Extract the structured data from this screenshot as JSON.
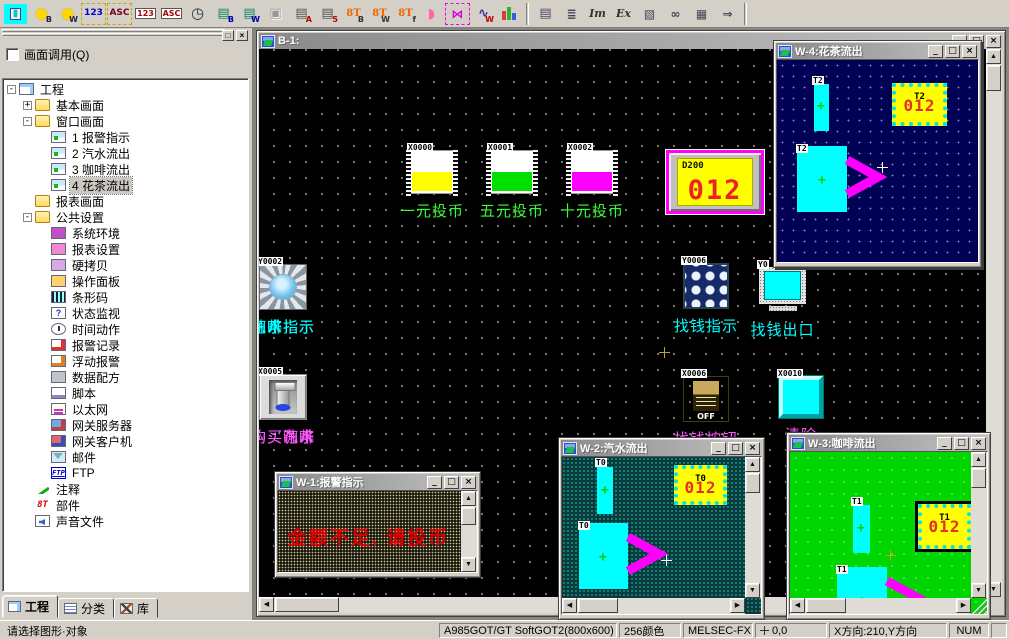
{
  "toolbar": {
    "group1": [
      {
        "name": "parts-select-dropdown-icon",
        "main": "S",
        "sub": "▾",
        "cls": "s-red"
      },
      {
        "name": "lamp-b-icon",
        "main": "●",
        "sub": "B",
        "cls": "lamp"
      },
      {
        "name": "lamp-w-icon",
        "main": "●",
        "sub": "W",
        "cls": "lamp"
      },
      {
        "name": "numeric-input-icon",
        "main": "123",
        "cls": "dashed blue"
      },
      {
        "name": "ascii-input-icon",
        "main": "ASC",
        "cls": "dashed dark"
      },
      {
        "name": "numeric-display-icon",
        "main": "123",
        "cls": "boxed"
      },
      {
        "name": "ascii-display-icon",
        "main": "ASC",
        "cls": "boxed"
      },
      {
        "name": "clock-display-icon",
        "main": "◷",
        "cls": "clock"
      },
      {
        "name": "comment-display-b-icon",
        "main": "▤",
        "sub": "B",
        "cls": "green-doc"
      },
      {
        "name": "comment-display-w-icon",
        "main": "▤",
        "sub": "W",
        "cls": "green-doc"
      },
      {
        "name": "paste-disabled-icon",
        "main": "▣",
        "cls": "disabled"
      },
      {
        "name": "alarm-history-icon",
        "main": "▤",
        "sub": "A",
        "cls": "alarm"
      },
      {
        "name": "alarm-list-icon",
        "main": "▤",
        "sub": "5",
        "cls": "alarm"
      },
      {
        "name": "parts-display-b-icon",
        "main": "8T",
        "sub": "B",
        "cls": "orange"
      },
      {
        "name": "parts-display-w-icon",
        "main": "8T",
        "sub": "W",
        "cls": "orange"
      },
      {
        "name": "parts-display-f-icon",
        "main": "8T",
        "sub": "f",
        "cls": "orange"
      },
      {
        "name": "panel-meter-icon",
        "main": "◗",
        "cls": "pink"
      },
      {
        "name": "tank-icon",
        "main": "▮",
        "cls": "tank"
      },
      {
        "name": "free-figure-icon",
        "main": "⋈",
        "cls": "fish"
      },
      {
        "name": "line-graph-icon",
        "main": "∿",
        "sub": "W",
        "cls": "graph"
      },
      {
        "name": "bar-graph-icon",
        "main": "",
        "cls": "bars"
      }
    ],
    "group2": [
      {
        "name": "report-icon",
        "main": "▤",
        "cls": "note"
      },
      {
        "name": "outline-list-icon",
        "main": "≣",
        "cls": "plain"
      },
      {
        "name": "import-icon",
        "main": "Im",
        "cls": "serif"
      },
      {
        "name": "export-icon",
        "main": "Ex",
        "cls": "serif"
      },
      {
        "name": "preview-icon",
        "main": "▧",
        "cls": "plain"
      },
      {
        "name": "find-icon",
        "main": "∞",
        "cls": "plain"
      },
      {
        "name": "grid-icon",
        "main": "▦",
        "cls": "plain"
      },
      {
        "name": "next-icon",
        "main": "⇒",
        "cls": "plain"
      }
    ]
  },
  "sidebar": {
    "panel_label": "画面调用(Q)",
    "tree": [
      {
        "name": "tree-item-project",
        "label": "工程",
        "level": 0,
        "expand": "-",
        "icon": "project"
      },
      {
        "name": "tree-item-base-screens",
        "label": "基本画面",
        "level": 1,
        "expand": "+",
        "icon": "folder"
      },
      {
        "name": "tree-item-window-screens",
        "label": "窗口画面",
        "level": 1,
        "expand": "-",
        "icon": "folder"
      },
      {
        "name": "tree-item-screen-1",
        "label": "1  报警指示",
        "level": 2,
        "icon": "screen"
      },
      {
        "name": "tree-item-screen-2",
        "label": "2  汽水流出",
        "level": 2,
        "icon": "screen"
      },
      {
        "name": "tree-item-screen-3",
        "label": "3  咖啡流出",
        "level": 2,
        "icon": "screen"
      },
      {
        "name": "tree-item-screen-4",
        "label": "4  花茶流出",
        "level": 2,
        "icon": "screen",
        "selected": true
      },
      {
        "name": "tree-item-report-screens",
        "label": "报表画面",
        "level": 1,
        "icon": "folder"
      },
      {
        "name": "tree-item-common-settings",
        "label": "公共设置",
        "level": 1,
        "expand": "-",
        "icon": "folder"
      },
      {
        "name": "tree-item-system-env",
        "label": "系统环境",
        "level": 2,
        "icon": "sys"
      },
      {
        "name": "tree-item-report-settings",
        "label": "报表设置",
        "level": 2,
        "icon": "report2"
      },
      {
        "name": "tree-item-hardcopy",
        "label": "硬拷贝",
        "level": 2,
        "icon": "copy"
      },
      {
        "name": "tree-item-operation-panel",
        "label": "操作面板",
        "level": 2,
        "icon": "panel"
      },
      {
        "name": "tree-item-barcode",
        "label": "条形码",
        "level": 2,
        "icon": "barcode"
      },
      {
        "name": "tree-item-status-watch",
        "label": "状态监视",
        "level": 2,
        "icon": "status"
      },
      {
        "name": "tree-item-time-action",
        "label": "时间动作",
        "level": 2,
        "icon": "time"
      },
      {
        "name": "tree-item-alarm-record",
        "label": "报警记录",
        "level": 2,
        "icon": "alarmrec"
      },
      {
        "name": "tree-item-floating-alarm",
        "label": "浮动报警",
        "level": 2,
        "icon": "floatalarm"
      },
      {
        "name": "tree-item-data-recipe",
        "label": "数据配方",
        "level": 2,
        "icon": "recipe"
      },
      {
        "name": "tree-item-script",
        "label": "脚本",
        "level": 2,
        "icon": "script"
      },
      {
        "name": "tree-item-ethernet",
        "label": "以太网",
        "level": 2,
        "icon": "ethernet"
      },
      {
        "name": "tree-item-gateway-server",
        "label": "网关服务器",
        "level": 2,
        "icon": "gwserver"
      },
      {
        "name": "tree-item-gateway-client",
        "label": "网关客户机",
        "level": 2,
        "icon": "gwclient"
      },
      {
        "name": "tree-item-mail",
        "label": "邮件",
        "level": 2,
        "icon": "mail"
      },
      {
        "name": "tree-item-ftp",
        "label": "FTP",
        "level": 2,
        "icon": "ftp",
        "iconText": "FTP"
      },
      {
        "name": "tree-item-comment",
        "label": "注释",
        "level": 1,
        "icon": "pen"
      },
      {
        "name": "tree-item-parts",
        "label": "部件",
        "level": 1,
        "icon": "parts",
        "iconText": "8T"
      },
      {
        "name": "tree-item-sound-files",
        "label": "声音文件",
        "level": 1,
        "icon": "sound"
      }
    ],
    "tabs": [
      {
        "label": "工程"
      },
      {
        "label": "分类"
      },
      {
        "label": "库"
      }
    ]
  },
  "b1": {
    "title": "B-1:",
    "coin_switches": [
      {
        "name": "coin-switch-1yuan",
        "tag": "X0000",
        "label": "一元投币",
        "color": "#ffff00"
      },
      {
        "name": "coin-switch-5yuan",
        "tag": "X0001",
        "label": "五元投币",
        "color": "#00e000"
      },
      {
        "name": "coin-switch-10yuan",
        "tag": "X0002",
        "label": "十元投币",
        "color": "#ff00ff"
      }
    ],
    "counter": {
      "tag": "D200",
      "value": "012"
    },
    "lamps": [
      {
        "name": "lamp-soda",
        "tag": "Y0000",
        "label": "汽水指示"
      },
      {
        "name": "lamp-coffee",
        "tag": "Y0001",
        "label": "咖啡指示"
      },
      {
        "name": "lamp-tea",
        "tag": "Y0002",
        "label": "花茶指示"
      }
    ],
    "change_lamp": {
      "tag": "Y0006",
      "label": "找钱指示"
    },
    "change_outlet": {
      "tag": "Y0",
      "label": "找钱出口"
    },
    "buy_buttons": [
      {
        "name": "button-buy-soda",
        "tag": "X0003",
        "label": "购买汽水"
      },
      {
        "name": "button-buy-coffee",
        "tag": "X0004",
        "label": "购买咖啡"
      },
      {
        "name": "button-buy-tea",
        "tag": "X0005",
        "label": "购买花茶"
      }
    ],
    "change_button": {
      "tag": "X0006",
      "label": "找钱按钮",
      "state": "OFF"
    },
    "clear_button": {
      "tag": "X0010",
      "label": "清除"
    }
  },
  "windows": {
    "w1": {
      "title": "W-1:报警指示",
      "alarm_text": "金额不足, 请投币"
    },
    "w2": {
      "title": "W-2:汽水流出",
      "tank_tag": "T0",
      "display_tag": "T0",
      "display_value": "012",
      "cup_tag": "T0"
    },
    "w3": {
      "title": "W-3:咖啡流出",
      "tank_tag": "T1",
      "display_tag": "T1",
      "display_value": "012",
      "cup_tag": "T1"
    },
    "w4": {
      "title": "W-4:花茶流出",
      "tank_tag": "T2",
      "display_tag": "T2",
      "display_value": "012",
      "cup_tag": "T2"
    }
  },
  "window_buttons": {
    "minimize": "_",
    "restore": "□",
    "close": "×"
  },
  "statusbar": {
    "hint": "请选择图形·对象",
    "device": "A985GOT/GT SoftGOT2(800x600)",
    "colors": "256颜色",
    "plc": "MELSEC-FX",
    "coords": "0,0",
    "direction": "X方向:210,Y方向",
    "num_lock": "NUM"
  }
}
